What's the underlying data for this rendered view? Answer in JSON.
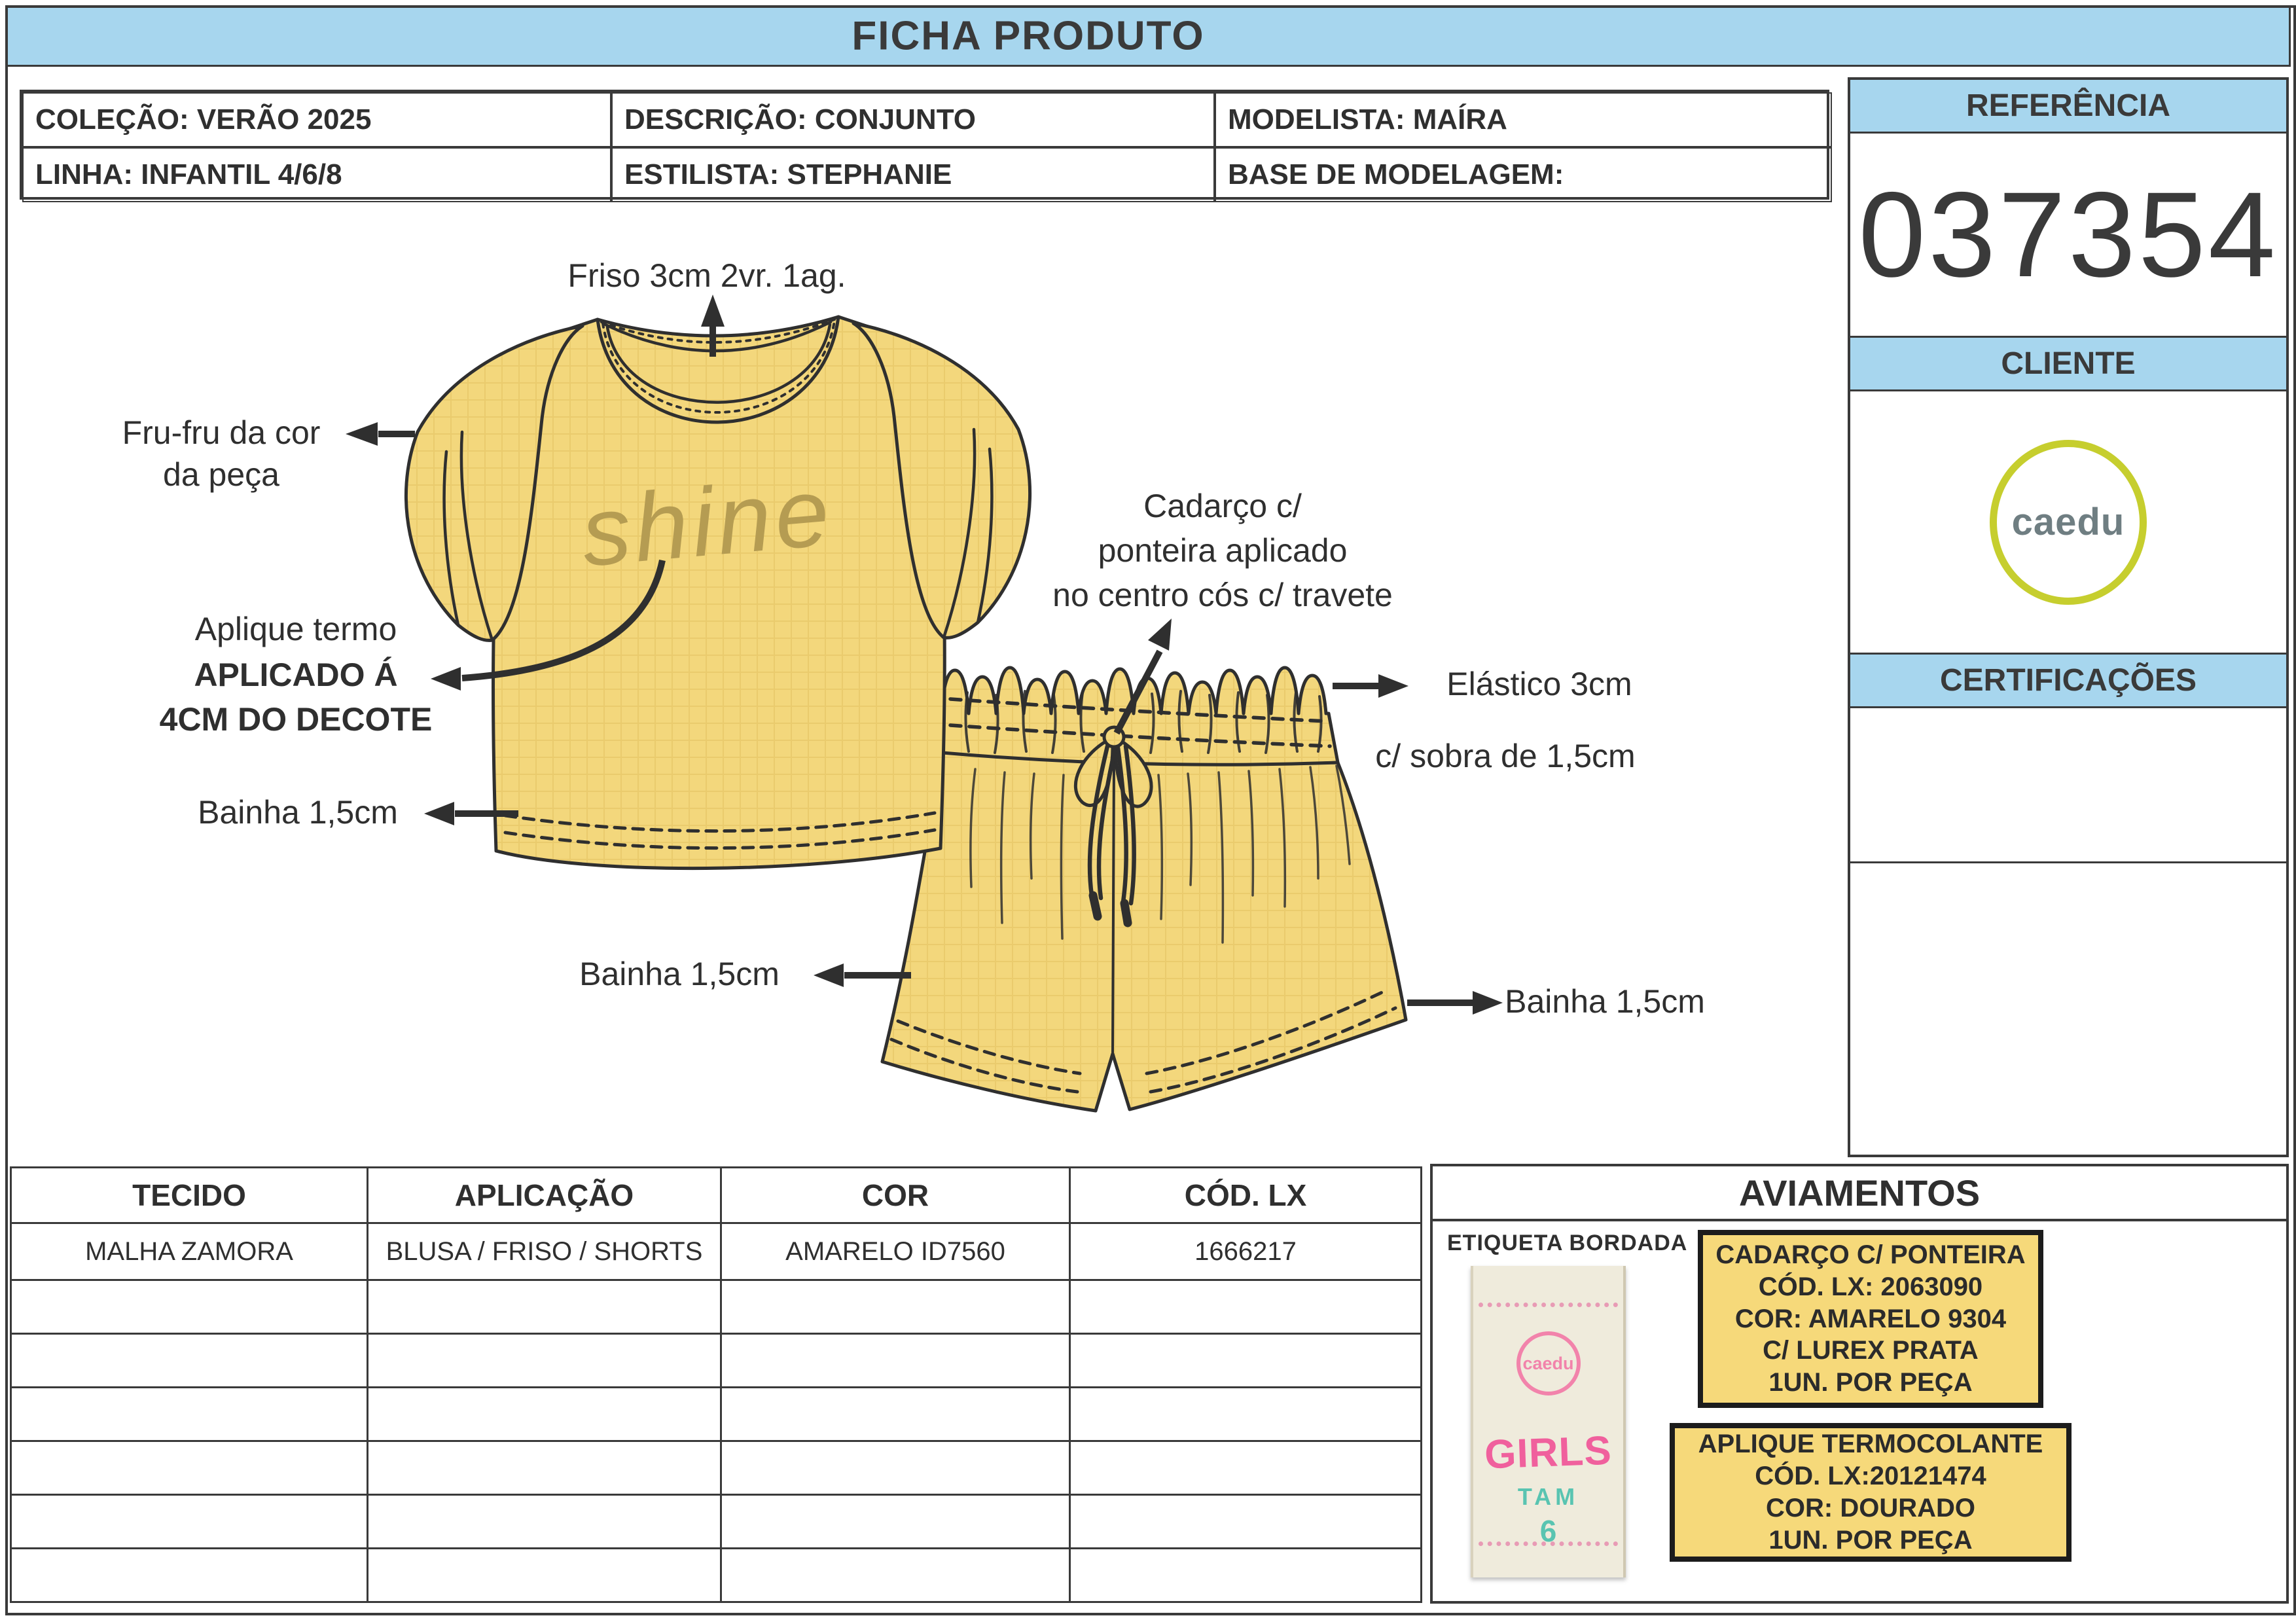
{
  "title": "FICHA PRODUTO",
  "info": {
    "colecao": "COLEÇÃO: VERÃO 2025",
    "descricao": "DESCRIÇÃO: CONJUNTO",
    "modelista": "MODELISTA: MAÍRA",
    "linha": "LINHA: INFANTIL 4/6/8",
    "estilista": "ESTILISTA: STEPHANIE",
    "base_modelagem": "BASE DE MODELAGEM:"
  },
  "sidebar": {
    "referencia_label": "REFERÊNCIA",
    "referencia_value": "037354",
    "cliente_label": "CLIENTE",
    "cliente_logo": "caedu",
    "certificacoes_label": "CERTIFICAÇÕES"
  },
  "drawing": {
    "shine_text": "shine",
    "annotations": {
      "friso": "Friso 3cm 2vr. 1ag.",
      "frufru_1": "Fru-fru da cor",
      "frufru_2": "da peça",
      "aplique_1": "Aplique termo",
      "aplique_2": "APLICADO Á",
      "aplique_3": "4CM DO DECOTE",
      "bainha_blusa": "Bainha 1,5cm",
      "cadarco_1": "Cadarço c/",
      "cadarco_2": "ponteira aplicado",
      "cadarco_3": "no centro cós c/ travete",
      "elastico_1": "Elástico 3cm",
      "elastico_2": "c/ sobra de 1,5cm",
      "bainha_shorts_esq": "Bainha 1,5cm",
      "bainha_shorts_dir": "Bainha 1,5cm"
    }
  },
  "materials_table": {
    "headers": [
      "TECIDO",
      "APLICAÇÃO",
      "COR",
      "CÓD. LX"
    ],
    "rows": [
      [
        "MALHA ZAMORA",
        "BLUSA / FRISO / SHORTS",
        "AMARELO ID7560",
        "1666217"
      ],
      [
        "",
        "",
        "",
        ""
      ],
      [
        "",
        "",
        "",
        ""
      ],
      [
        "",
        "",
        "",
        ""
      ],
      [
        "",
        "",
        "",
        ""
      ],
      [
        "",
        "",
        "",
        ""
      ],
      [
        "",
        "",
        "",
        ""
      ]
    ]
  },
  "aviamentos": {
    "title": "AVIAMENTOS",
    "etiqueta_label": "ETIQUETA BORDADA",
    "tag": {
      "brand": "caedu",
      "line1": "GIRLS",
      "line2": "TAM",
      "line3": "6"
    },
    "box1": {
      "lines": [
        "CADARÇO C/ PONTEIRA",
        "CÓD. LX: 2063090",
        "COR: AMARELO 9304",
        "C/ LUREX PRATA",
        "1UN. POR PEÇA"
      ]
    },
    "box2": {
      "lines": [
        "APLIQUE TERMOCOLANTE",
        "CÓD. LX:20121474",
        "COR: DOURADO",
        "1UN. POR PEÇA"
      ]
    }
  },
  "colors": {
    "header_blue": "#A7D6EE",
    "fabric_yellow": "#F3D77C",
    "outline_dark": "#2f2f2f",
    "trim_box_yellow": "#F6D97A",
    "logo_ring_green": "#C6CE2E",
    "logo_text_gray": "#6F7E82",
    "tag_pink": "#F0609D",
    "tag_teal": "#59C4B1",
    "shine_gold": "#B59C52"
  }
}
